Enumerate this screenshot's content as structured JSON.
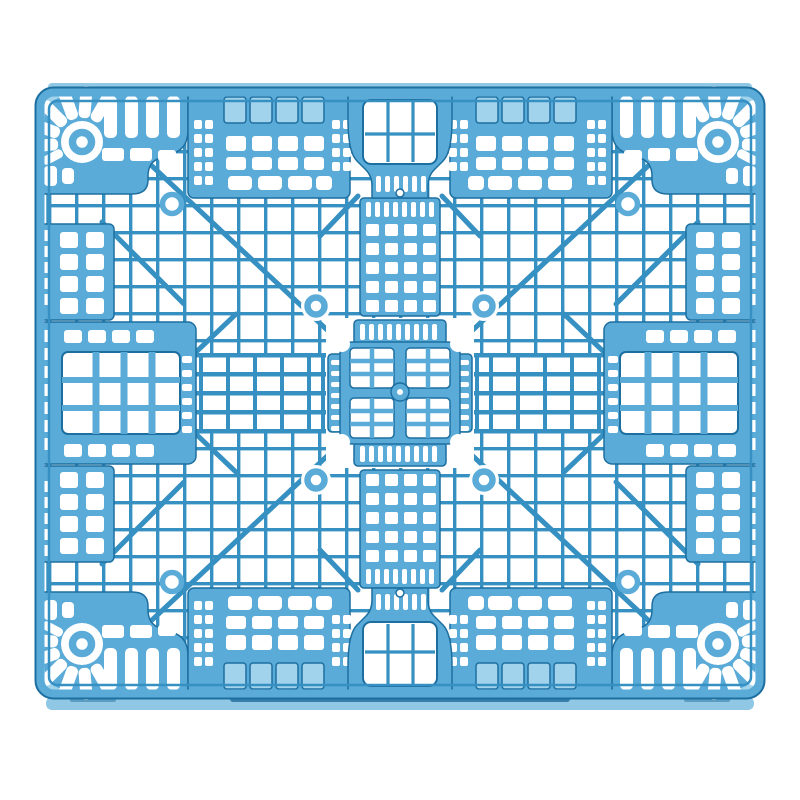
{
  "image": {
    "kind": "product-photo",
    "subject": "blue plastic grid pallet",
    "view": "top view",
    "background": "white",
    "aria_label": "Top view photograph of a blue plastic grid pallet with mesh deck, corner fan ribs, round vent holes and diagonal reinforcement ribs on a white background"
  },
  "colors": {
    "background": "#ffffff",
    "primary": "#5aabd8",
    "primary_light": "#a2d3ec",
    "primary_dark": "#1d6fa0",
    "mesh_line": "#3690c2",
    "deep_line": "#14618f",
    "skirt": "#8fc7e5",
    "shadow_line": "#27719f"
  }
}
